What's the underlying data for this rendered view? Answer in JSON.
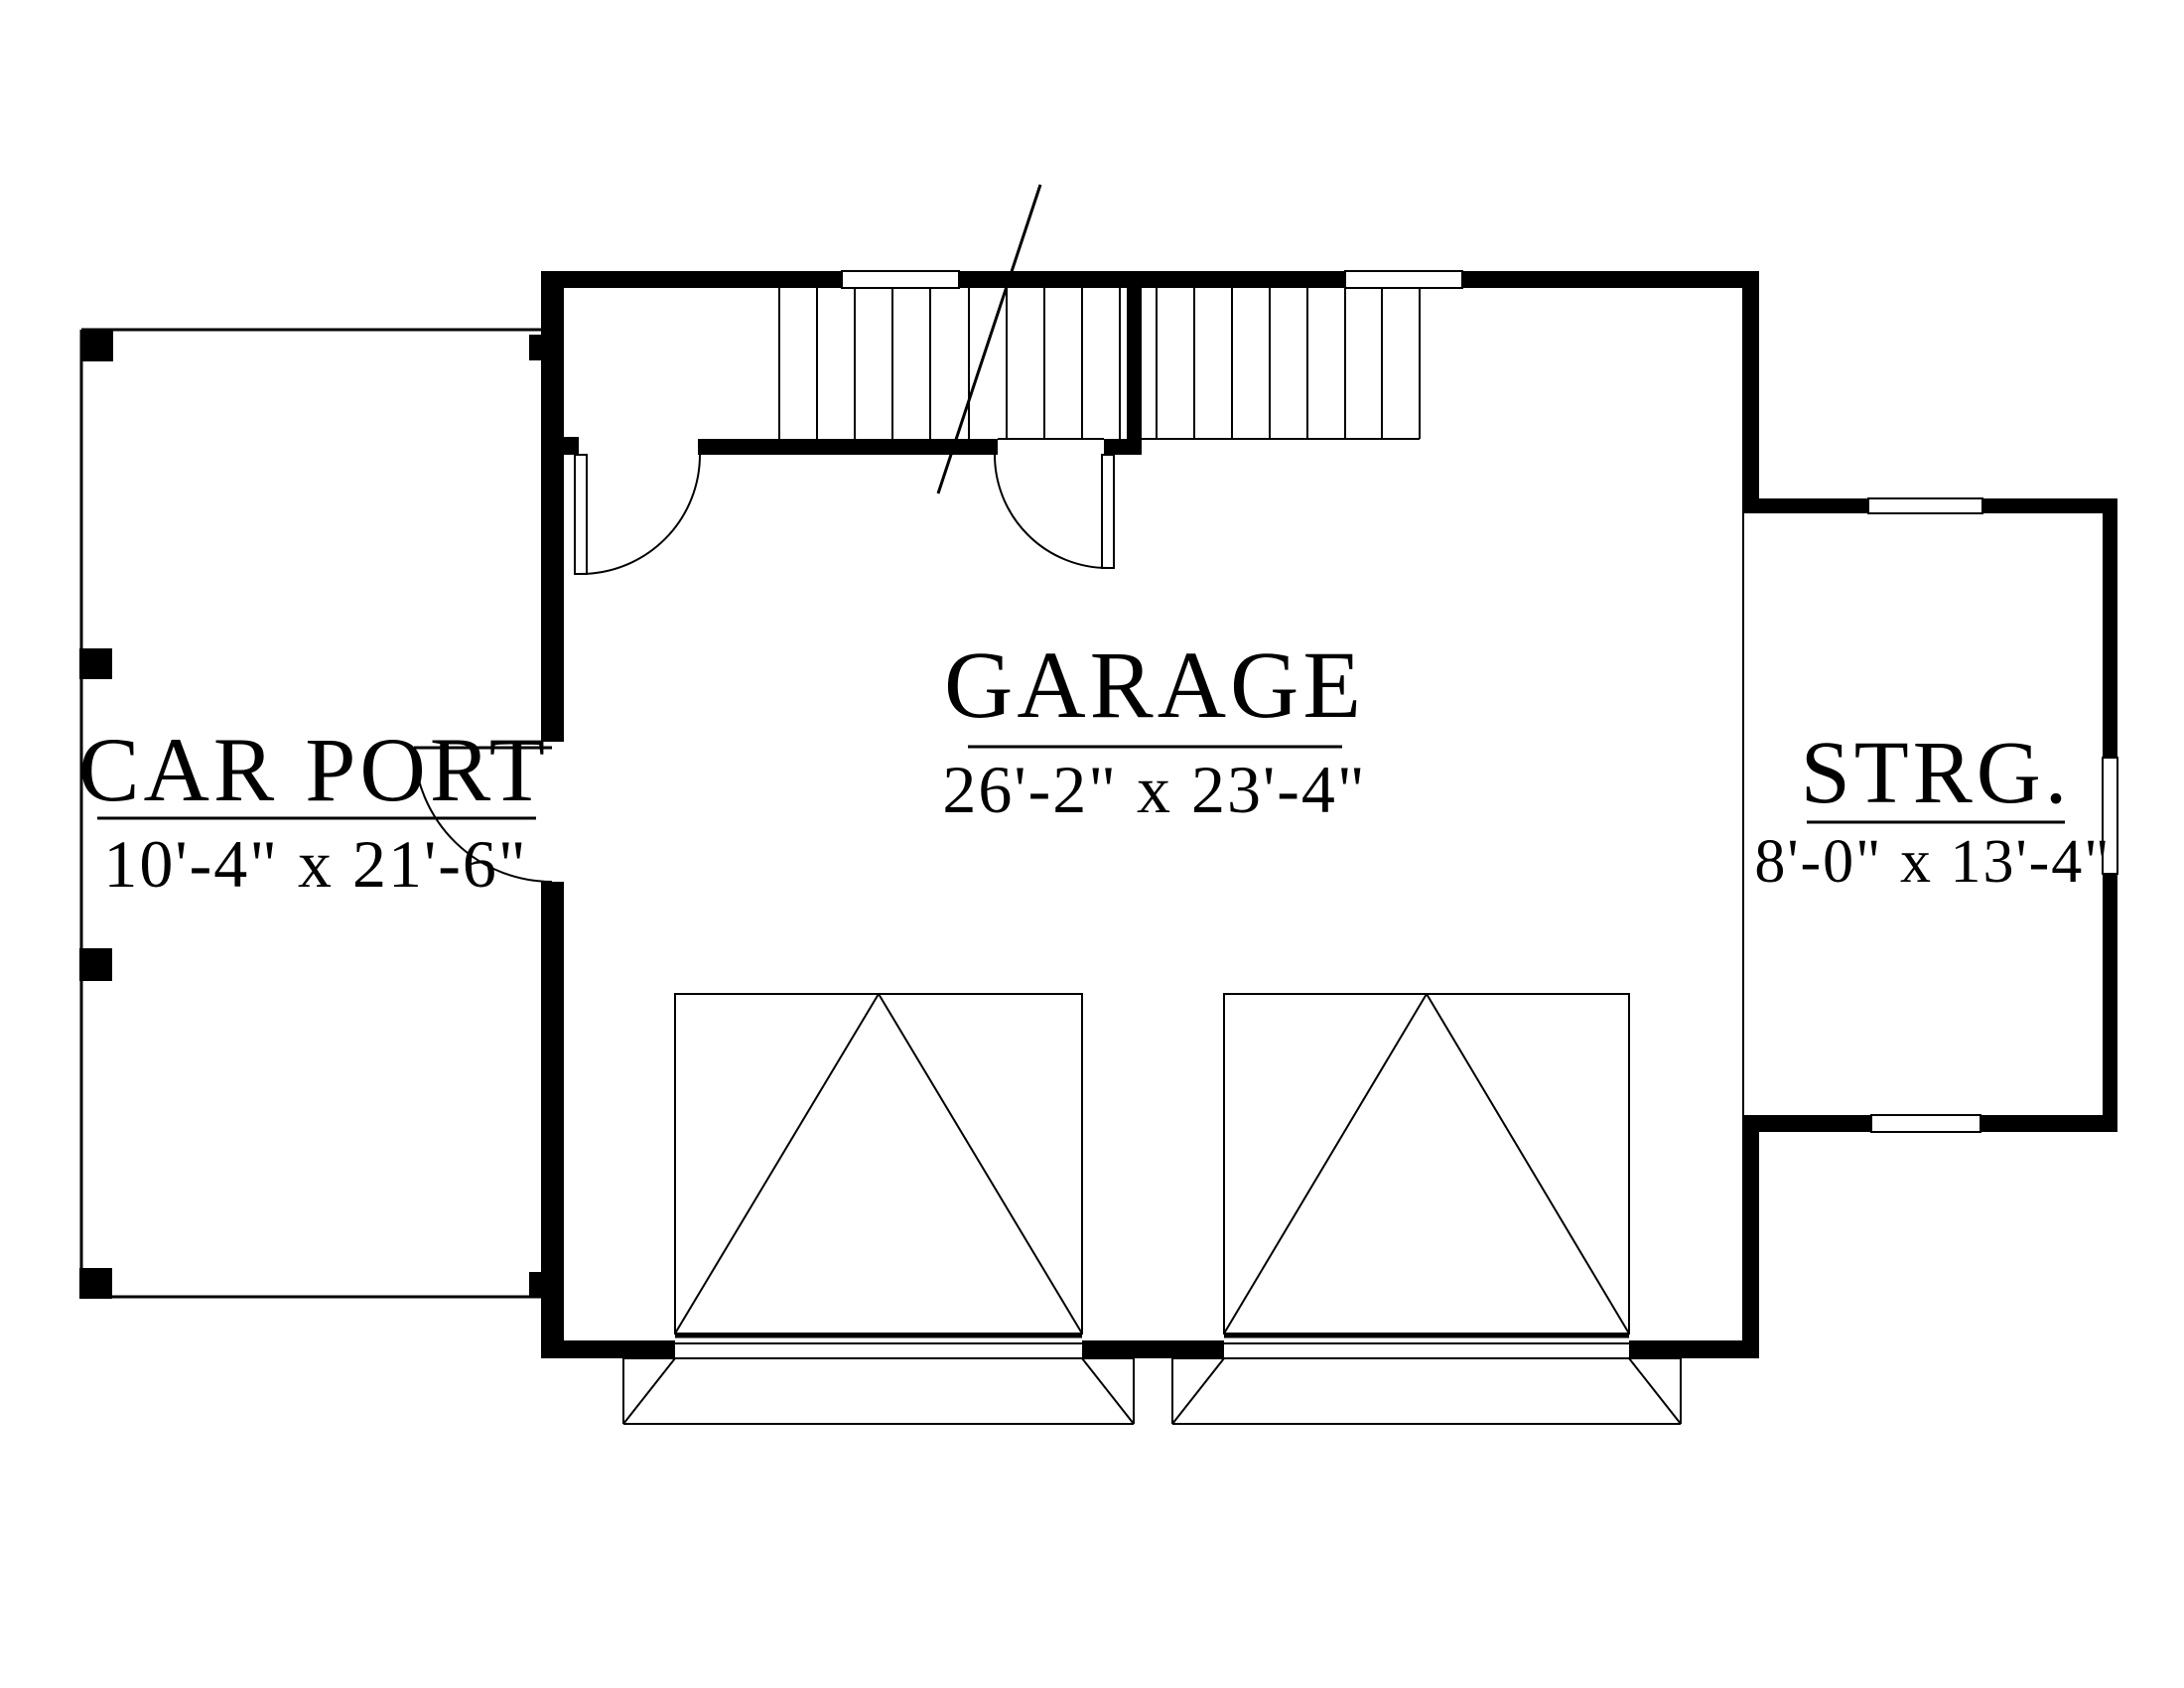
{
  "plan": {
    "title": "Garage floor plan",
    "rooms": {
      "garage": {
        "label": "GARAGE",
        "dimensions": "26'-2\" x 23'-4\""
      },
      "carport": {
        "label": "CAR PORT",
        "dimensions": "10'-4\" x 21'-6\""
      },
      "storage": {
        "label": "STRG.",
        "dimensions": "8'-0\" x 13'-4\""
      }
    },
    "colors": {
      "wall": "#000000",
      "background": "#ffffff",
      "line": "#000000"
    }
  }
}
